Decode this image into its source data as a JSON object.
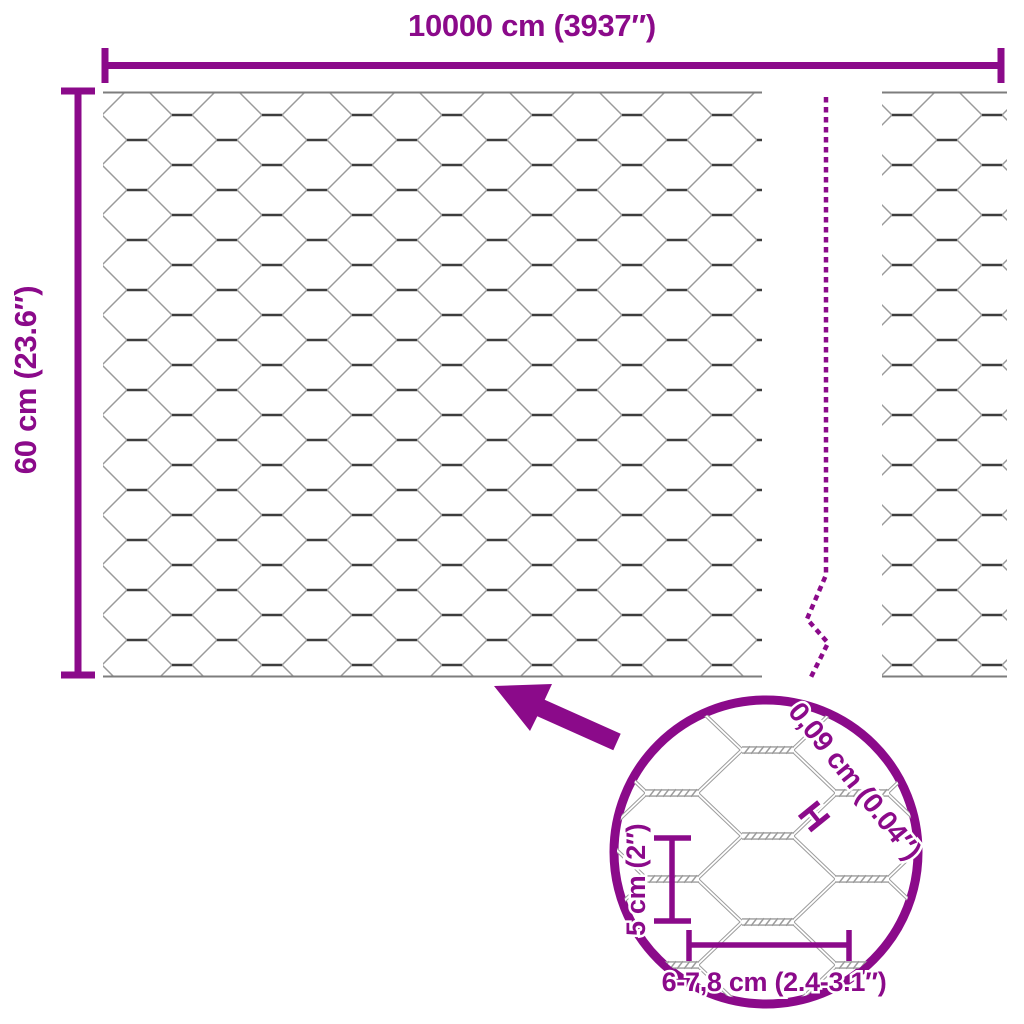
{
  "diagram": {
    "width_label": "10000 cm (3937″)",
    "height_label": "60 cm (23.6″)",
    "detail": {
      "wire_thickness_label": "0,09 cm (0.04″)",
      "gauge_symbol": "H",
      "mesh_height_label": "5 cm (2″)",
      "mesh_width_label": "6-7,8 cm (2.4-3.1″)"
    },
    "colors": {
      "accent": "#8b0a8a",
      "mesh_diagonal": "#9a9a9a",
      "mesh_twist": "#3d3d3d",
      "selvedge": "#7d7d7d",
      "background": "#ffffff"
    }
  }
}
